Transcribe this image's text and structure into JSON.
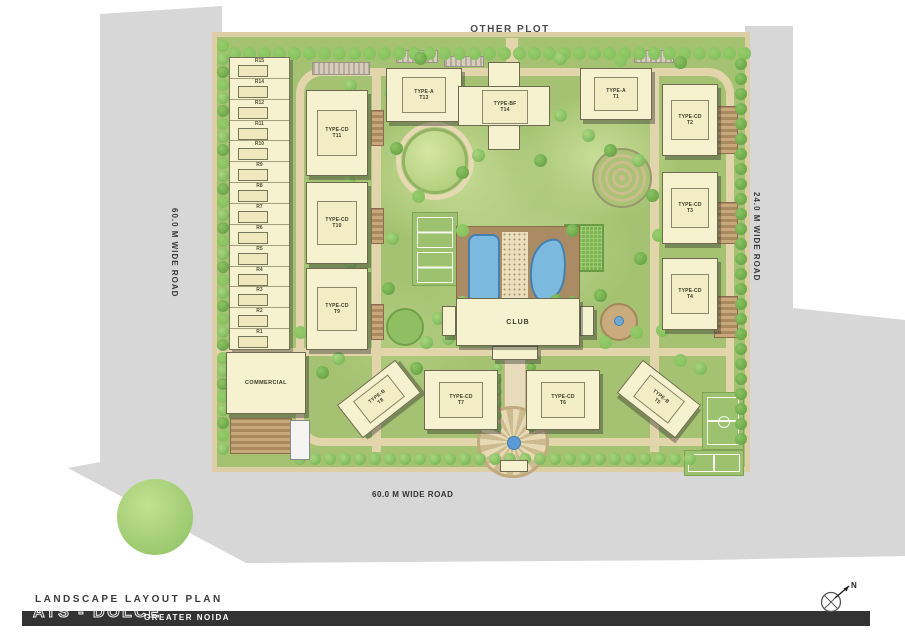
{
  "plan": {
    "other_plot": "OTHER PLOT",
    "roads": {
      "left": "60.0 M WIDE ROAD",
      "right": "24.0 M WIDE ROAD",
      "bottom": "60.0 M WIDE ROAD"
    },
    "towers": {
      "t13": {
        "type": "TYPE-A",
        "no": "T13"
      },
      "t14": {
        "type": "TYPE-BF",
        "no": "T14"
      },
      "t1": {
        "type": "TYPE-A",
        "no": "T1"
      },
      "t11": {
        "type": "TYPE-CD",
        "no": "T11"
      },
      "t10": {
        "type": "TYPE-CD",
        "no": "T10"
      },
      "t9": {
        "type": "TYPE-CD",
        "no": "T9"
      },
      "t2": {
        "type": "TYPE-CD",
        "no": "T2"
      },
      "t3": {
        "type": "TYPE-CD",
        "no": "T3"
      },
      "t4": {
        "type": "TYPE-CD",
        "no": "T4"
      },
      "t8": {
        "type": "TYPE-B",
        "no": "T8"
      },
      "t7": {
        "type": "TYPE-CD",
        "no": "T7"
      },
      "t6": {
        "type": "TYPE-CD",
        "no": "T6"
      },
      "t5": {
        "type": "TYPE-B",
        "no": "T5"
      }
    },
    "club": "CLUB",
    "commercial": "COMMERCIAL",
    "row_houses": [
      "R15",
      "R14",
      "R12",
      "R11",
      "R10",
      "R9",
      "R8",
      "R7",
      "R6",
      "R5",
      "R4",
      "R3",
      "R2",
      "R1"
    ],
    "compass_n": "N",
    "colors": {
      "road_gray": "#d7d7d7",
      "site_green": "#a4c271",
      "building_cream": "#f6f1ce",
      "pool_blue": "#7cb9de",
      "deck_brown": "#ab8b64",
      "footer_dark": "#333333"
    }
  },
  "footer": {
    "title": "LANDSCAPE LAYOUT PLAN",
    "project": "ATS - DOLCE",
    "location": "GREATER NOIDA"
  }
}
